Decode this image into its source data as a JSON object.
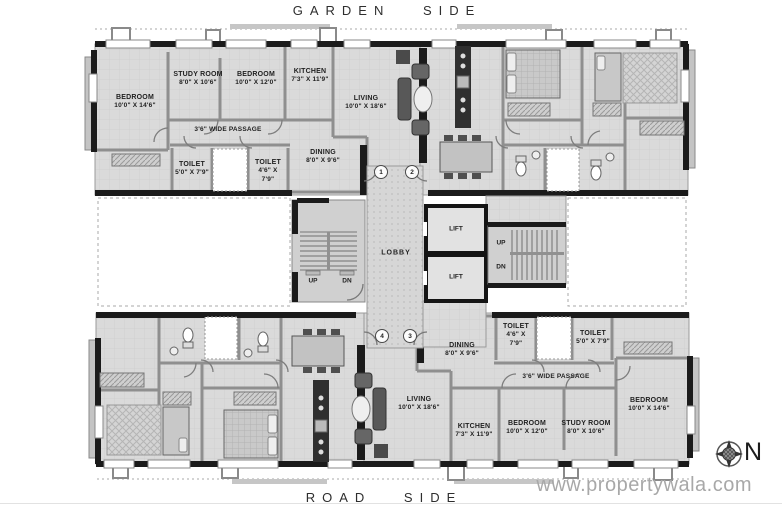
{
  "site": {
    "garden_side": "GARDEN SIDE",
    "road_side": "ROAD SIDE",
    "watermark": "www.propertywala.com",
    "compass": {
      "north_label": "N"
    }
  },
  "colors": {
    "wall": "#1b1b1b",
    "floor": "#dadada",
    "label_text": "#1f1f1f",
    "watermark_gray": "#a8a8a8"
  },
  "core": {
    "lobby_label": "LOBBY",
    "lift_top_label": "LIFT",
    "lift_bottom_label": "LIFT",
    "stairs_left": {
      "up_label": "UP",
      "down_label": "DN"
    },
    "stairs_right": {
      "up_label": "UP",
      "down_label": "DN"
    },
    "flat_markers": {
      "flat1": "1",
      "flat2": "2",
      "flat3": "3",
      "flat4": "4"
    }
  },
  "unit_top_left": {
    "bedroom_large": {
      "name": "BEDROOM",
      "dims": "10'0\" X 14'6\""
    },
    "study_room": {
      "name": "STUDY ROOM",
      "dims": "8'0\" X 10'6\""
    },
    "bedroom_small": {
      "name": "BEDROOM",
      "dims": "10'0\" X 12'0\""
    },
    "kitchen": {
      "name": "KITCHEN",
      "dims": "7'3\" X 11'9\""
    },
    "living": {
      "name": "LIVING",
      "dims": "10'0\" X 18'6\""
    },
    "dining": {
      "name": "DINING",
      "dims": "8'0\" X 9'6\""
    },
    "passage": {
      "name": "3'6\" WIDE PASSAGE"
    },
    "toilet_large": {
      "name": "TOILET",
      "dims": "5'0\" X 7'9\""
    },
    "toilet_small": {
      "name": "TOILET",
      "dims": "4'6\" X",
      "dims2": "7'9\""
    }
  },
  "unit_bottom_right": {
    "bedroom_large": {
      "name": "BEDROOM",
      "dims": "10'0\" X 14'6\""
    },
    "study_room": {
      "name": "STUDY ROOM",
      "dims": "8'0\" X 10'6\""
    },
    "bedroom_small": {
      "name": "BEDROOM",
      "dims": "10'0\" X 12'0\""
    },
    "kitchen": {
      "name": "KITCHEN",
      "dims": "7'3\" X 11'9\""
    },
    "living": {
      "name": "LIVING",
      "dims": "10'0\" X 18'6\""
    },
    "dining": {
      "name": "DINING",
      "dims": "8'0\" X 9'6\""
    },
    "passage": {
      "name": "3'6\" WIDE PASSAGE"
    },
    "toilet_large": {
      "name": "TOILET",
      "dims": "5'0\" X 7'9\""
    },
    "toilet_small": {
      "name": "TOILET",
      "dims": "4'6\" X",
      "dims2": "7'9\""
    }
  }
}
